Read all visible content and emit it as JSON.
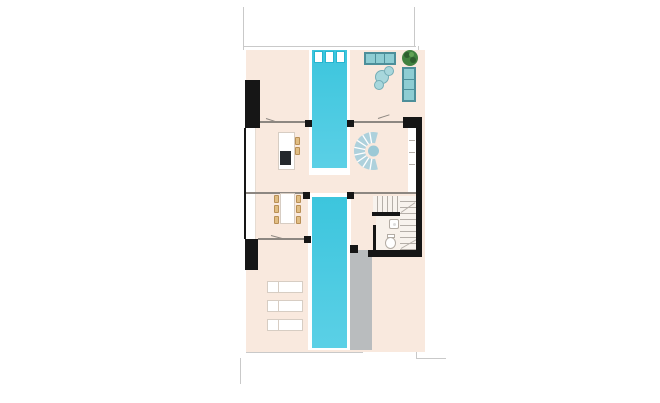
{
  "title": "Floor plan — ground floor with linear pool",
  "colors": {
    "floor": "#f9e9de",
    "wall": "#161616",
    "pool": "#3cc5dd",
    "pool-deep": "#5bd0e6",
    "pool-frame": "#25b5cf",
    "deck": "#b9bcbe",
    "sofa-fill": "#8ecdd3",
    "sofa-edge": "#4d8f9a",
    "pouf-fill": "#a8d7dc",
    "pouf-edge": "#74adb6",
    "plant": "#41813f",
    "plant-dark": "#2e5e2e",
    "plant-light": "#63a355",
    "stool": "#e0bd83",
    "stool-edge": "#b98f55",
    "furniture-edge": "#d7cdc3",
    "line-light": "#c9c9c9",
    "line-wall": "#8d8781",
    "tread": "#b5afa9",
    "stair-floor": "#f8f3ee",
    "bath-floor": "#f8f1ea",
    "cooktop": "#24282c",
    "fixture-edge": "#b3aca4",
    "spiral": "#aed1dc",
    "spiral-center": "#9cc9d6"
  },
  "elements": {
    "plan": {
      "name": "ground-floor-plan"
    },
    "plot": {
      "name": "building-plot"
    },
    "pool": {
      "name": "swimming-pool"
    },
    "pool_panels": {
      "name": "pool-glass-panels"
    },
    "deck": {
      "name": "concrete-pool-deck"
    },
    "sofa_top": {
      "name": "three-seat-sofa"
    },
    "sofa_side": {
      "name": "two-seat-side-sofa"
    },
    "poufs": {
      "name": "round-poufs"
    },
    "plant": {
      "name": "potted-plant"
    },
    "kitchen_island": {
      "name": "kitchen-island"
    },
    "cooktop": {
      "name": "cooktop"
    },
    "stools": {
      "name": "bar-stools"
    },
    "dining_table": {
      "name": "dining-table"
    },
    "chairs": {
      "name": "dining-chairs"
    },
    "spiral_stair": {
      "name": "spiral-staircase"
    },
    "stair": {
      "name": "u-shaped-staircase"
    },
    "landing": {
      "name": "stair-landing-wall"
    },
    "bathroom": {
      "name": "bathroom"
    },
    "toilet": {
      "name": "toilet"
    },
    "sink": {
      "name": "washbasin"
    },
    "sun_loungers": {
      "name": "sun-lounger"
    },
    "walls": {
      "name": "exterior-wall"
    },
    "glass_facade": {
      "name": "glass-facade"
    },
    "shelf": {
      "name": "wall-shelf"
    },
    "boundary": {
      "name": "plot-boundary-line"
    },
    "column": {
      "name": "structural-column"
    },
    "partition": {
      "name": "interior-wall-line"
    },
    "door": {
      "name": "door-swing"
    }
  }
}
